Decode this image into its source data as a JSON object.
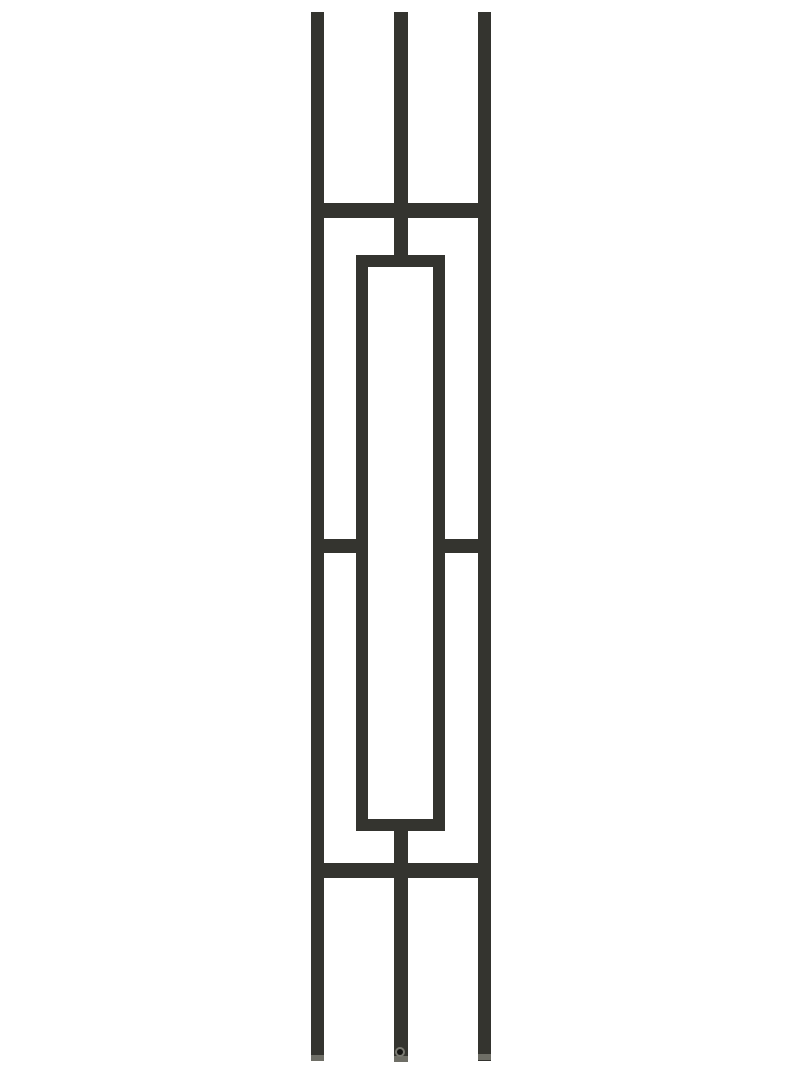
{
  "meta": {
    "description": "Product photograph of a black wrought-iron stair baluster with a modern double-bar and center-rectangle geometric design, shown vertically on a plain white background"
  },
  "colors": {
    "background": "#ffffff",
    "metal": "#34342f",
    "metal_highlight": "#54544d",
    "end_cap": "#6e6e66",
    "hole": "#151513",
    "hole_rim": "#7a7a72"
  },
  "canvas": {
    "width": 800,
    "height": 1067
  },
  "parts": [
    {
      "name": "left-vertical-bar",
      "type": "rect",
      "x": 311,
      "y": 12,
      "w": 13,
      "h": 1049
    },
    {
      "name": "center-vertical-bar-upper",
      "type": "rect",
      "x": 394,
      "y": 12,
      "w": 14,
      "h": 250
    },
    {
      "name": "center-vertical-bar-lower",
      "type": "rect",
      "x": 394,
      "y": 822,
      "w": 14,
      "h": 240
    },
    {
      "name": "right-vertical-bar",
      "type": "rect",
      "x": 478,
      "y": 12,
      "w": 13,
      "h": 1049
    },
    {
      "name": "top-horizontal-rail",
      "type": "rect",
      "x": 311,
      "y": 203,
      "w": 180,
      "h": 15
    },
    {
      "name": "middle-left-connector",
      "type": "rect",
      "x": 311,
      "y": 539,
      "w": 57,
      "h": 14
    },
    {
      "name": "middle-right-connector",
      "type": "rect",
      "x": 433,
      "y": 539,
      "w": 58,
      "h": 14
    },
    {
      "name": "bottom-horizontal-rail",
      "type": "rect",
      "x": 311,
      "y": 863,
      "w": 180,
      "h": 15
    },
    {
      "name": "center-rectangle-frame",
      "type": "frame",
      "x": 356,
      "y": 255,
      "w": 89,
      "h": 576,
      "stroke": 12
    },
    {
      "name": "left-bar-end-cap",
      "type": "rect",
      "x": 311,
      "y": 1055,
      "w": 13,
      "h": 6,
      "fill": "end_cap"
    },
    {
      "name": "center-bar-end-cap",
      "type": "rect",
      "x": 394,
      "y": 1056,
      "w": 14,
      "h": 6,
      "fill": "end_cap"
    },
    {
      "name": "right-bar-end-cap",
      "type": "rect",
      "x": 478,
      "y": 1054,
      "w": 13,
      "h": 6,
      "fill": "end_cap"
    },
    {
      "name": "set-screw-hole-rim",
      "type": "circle",
      "cx": 400,
      "cy": 1052,
      "r": 5,
      "fill": "hole_rim"
    },
    {
      "name": "set-screw-hole",
      "type": "circle",
      "cx": 400,
      "cy": 1052,
      "r": 3,
      "fill": "hole"
    }
  ]
}
